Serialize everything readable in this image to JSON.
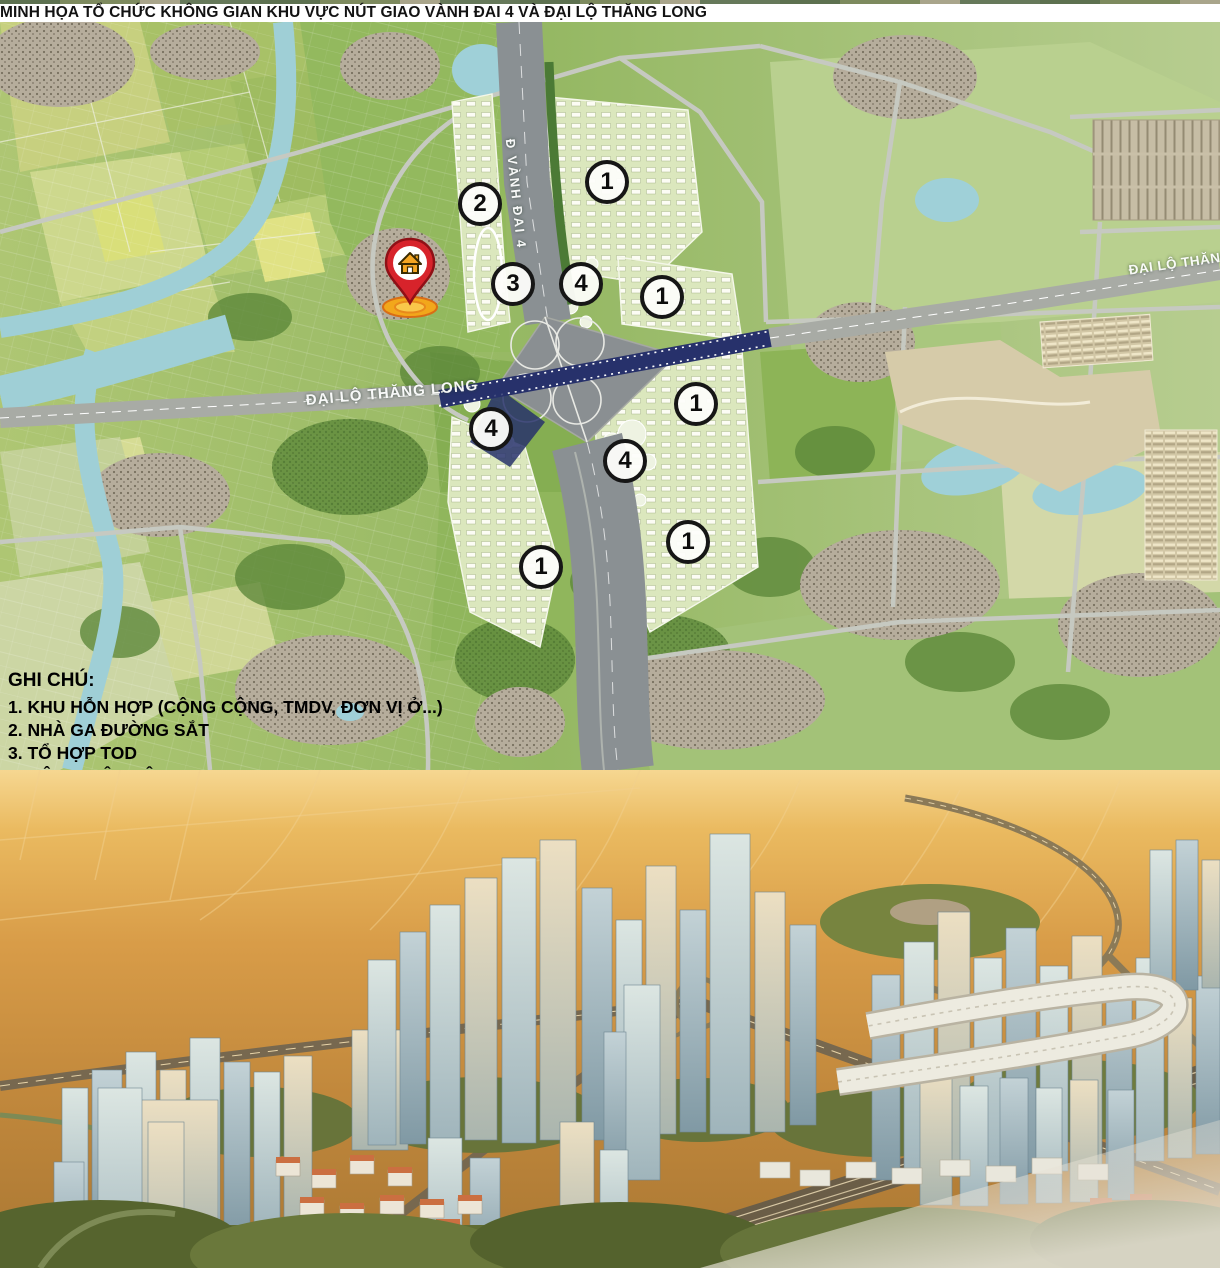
{
  "title": "MINH HỌA TỔ CHỨC KHÔNG GIAN KHU VỰC NÚT GIAO VÀNH ĐAI 4 VÀ ĐẠI LỘ THĂNG LONG",
  "map": {
    "road_labels": [
      {
        "text": "Đ VÀNH ĐAI 4",
        "x": 516,
        "y": 172,
        "rot": 84,
        "size": 13,
        "spacing": 2
      },
      {
        "text": "ĐẠI LỘ THĂNG LONG",
        "x": 392,
        "y": 371,
        "rot": -5,
        "size": 15,
        "spacing": 1
      },
      {
        "text": "ĐẠI LỘ THĂNG",
        "x": 1180,
        "y": 241,
        "rot": -8,
        "size": 13.5,
        "spacing": 0.5
      }
    ],
    "markers": [
      {
        "label": "2",
        "x": 480,
        "y": 182
      },
      {
        "label": "1",
        "x": 607,
        "y": 160
      },
      {
        "label": "3",
        "x": 513,
        "y": 262
      },
      {
        "label": "4",
        "x": 581,
        "y": 262
      },
      {
        "label": "1",
        "x": 662,
        "y": 275
      },
      {
        "label": "4",
        "x": 491,
        "y": 407
      },
      {
        "label": "1",
        "x": 696,
        "y": 382
      },
      {
        "label": "4",
        "x": 625,
        "y": 439
      },
      {
        "label": "1",
        "x": 688,
        "y": 520
      },
      {
        "label": "1",
        "x": 541,
        "y": 545
      }
    ],
    "pin": {
      "x": 410,
      "y": 285
    },
    "legend": {
      "title": "GHI CHÚ:",
      "items": [
        "1. KHU HỖN HỢP (CỘNG CỘNG, TMDV, ĐƠN VỊ Ở...)",
        "2. NHÀ GA ĐƯỜNG SẮT",
        "3. TỔ HỢP TOD",
        "4. CÔNG VIÊN CÂY XANH"
      ]
    }
  }
}
